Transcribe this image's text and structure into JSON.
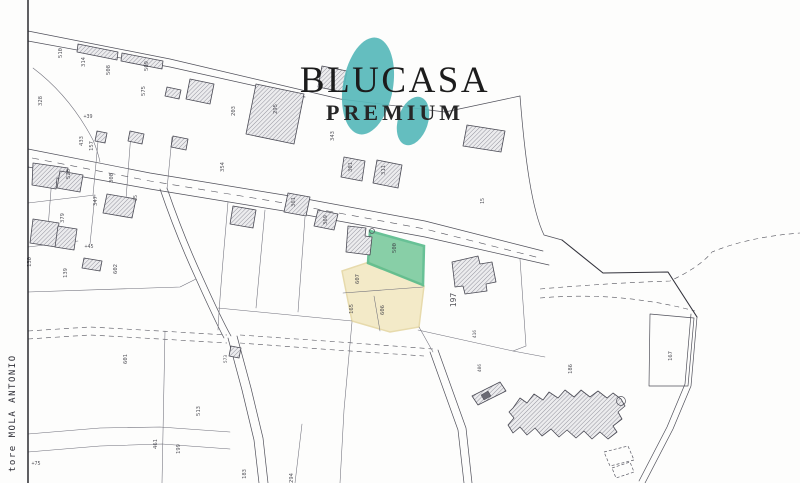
{
  "watermark": {
    "brand": "BLUCASA",
    "tier": "PREMIUM",
    "blob_color": "#57B9BA",
    "text_color": "#1C1C1C"
  },
  "margin_note": "tore MOLA ANTONIO",
  "highlight": {
    "green_parcel": {
      "number": "500",
      "fill": "#7CCB9E"
    },
    "yellow_parcel_numbers": [
      "607",
      "165",
      "606"
    ],
    "yellow_fill": "#F3EAC6",
    "large_parcel_number": "197"
  },
  "map_colors": {
    "paper": "#FDFDFC",
    "line": "#50505A",
    "hatch": "#7C7C88"
  },
  "parcel_labels": [
    {
      "t": "510",
      "x": 62,
      "y": 53
    },
    {
      "t": "314",
      "x": 85,
      "y": 62
    },
    {
      "t": "508",
      "x": 110,
      "y": 70
    },
    {
      "t": "509",
      "x": 148,
      "y": 66
    },
    {
      "t": "575",
      "x": 145,
      "y": 91
    },
    {
      "t": "328",
      "x": 42,
      "y": 101
    },
    {
      "t": "+39",
      "x": 88,
      "y": 118,
      "r": 0,
      "s": 5
    },
    {
      "t": "433",
      "x": 83,
      "y": 141
    },
    {
      "t": "157",
      "x": 93,
      "y": 146
    },
    {
      "t": "203",
      "x": 235,
      "y": 111
    },
    {
      "t": "295",
      "x": 277,
      "y": 109
    },
    {
      "t": "343",
      "x": 334,
      "y": 136
    },
    {
      "t": "354",
      "x": 224,
      "y": 167
    },
    {
      "t": "528",
      "x": 70,
      "y": 174
    },
    {
      "t": "308",
      "x": 113,
      "y": 178
    },
    {
      "t": "347",
      "x": 97,
      "y": 201
    },
    {
      "t": "379",
      "x": 64,
      "y": 218
    },
    {
      "t": "35",
      "x": 137,
      "y": 198,
      "s": 5
    },
    {
      "t": "301",
      "x": 352,
      "y": 167
    },
    {
      "t": "311",
      "x": 385,
      "y": 170
    },
    {
      "t": "361",
      "x": 295,
      "y": 202
    },
    {
      "t": "369",
      "x": 327,
      "y": 220
    },
    {
      "t": "15",
      "x": 484,
      "y": 201,
      "s": 5
    },
    {
      "t": "500",
      "x": 396,
      "y": 248
    },
    {
      "t": "607",
      "x": 359,
      "y": 279
    },
    {
      "t": "165",
      "x": 353,
      "y": 309
    },
    {
      "t": "606",
      "x": 384,
      "y": 310
    },
    {
      "t": "197",
      "x": 456,
      "y": 300,
      "s": 8
    },
    {
      "t": "416",
      "x": 476,
      "y": 334,
      "s": 4.5
    },
    {
      "t": "406",
      "x": 481,
      "y": 368,
      "s": 4.5
    },
    {
      "t": "186",
      "x": 572,
      "y": 369
    },
    {
      "t": "167",
      "x": 672,
      "y": 356
    },
    {
      "t": "+45",
      "x": 89,
      "y": 248,
      "r": 0,
      "s": 5
    },
    {
      "t": "130",
      "x": 31,
      "y": 262
    },
    {
      "t": "139",
      "x": 67,
      "y": 273
    },
    {
      "t": "602",
      "x": 117,
      "y": 269
    },
    {
      "t": "601",
      "x": 127,
      "y": 359
    },
    {
      "t": "573",
      "x": 227,
      "y": 359,
      "s": 4.5
    },
    {
      "t": "513",
      "x": 200,
      "y": 411
    },
    {
      "t": "461",
      "x": 157,
      "y": 444
    },
    {
      "t": "199",
      "x": 180,
      "y": 449
    },
    {
      "t": "183",
      "x": 246,
      "y": 474
    },
    {
      "t": "294",
      "x": 293,
      "y": 478
    },
    {
      "t": "+75",
      "x": 36,
      "y": 465,
      "r": 0,
      "s": 5
    }
  ]
}
